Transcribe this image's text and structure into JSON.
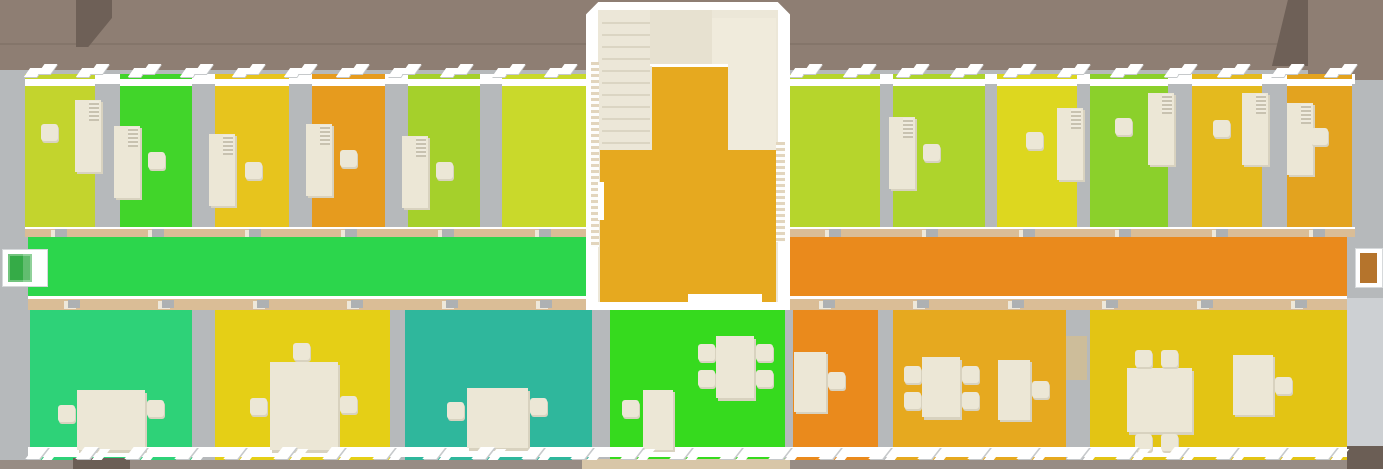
{
  "palette": {
    "roof": "#8e7e73",
    "roofDark": "#6e6057",
    "wall": "#b6b9bb",
    "wallLight": "#cdd0d3",
    "cream": "#ece7d6",
    "creamShadow": "#d8d2bf",
    "stairInterior": "#ece7d8",
    "stairStep": "#dbd5c3",
    "stairLanding": "#f0ebdc",
    "stairUpper": "#e7e1d0",
    "doorStrip": "#dabd96",
    "doorPanel": "#aeb1b3",
    "ground": "#978c84",
    "groundDark": "#6b5e55",
    "groundTan": "#d8c6a8"
  },
  "building": {
    "north_offices": [
      {
        "name": "north-office-1",
        "floor_color": "#c3d42d",
        "furniture": [
          "desk",
          "office-chair"
        ]
      },
      {
        "name": "north-office-2",
        "floor_color": "#41d52a",
        "furniture": [
          "desk",
          "office-chair"
        ]
      },
      {
        "name": "north-office-3",
        "floor_color": "#e7c41d",
        "furniture": [
          "desk",
          "office-chair"
        ]
      },
      {
        "name": "north-office-4",
        "floor_color": "#e69b1e",
        "furniture": [
          "desk",
          "office-chair"
        ]
      },
      {
        "name": "north-office-5",
        "floor_color": "#a5d02b",
        "furniture": [
          "desk",
          "office-chair"
        ]
      },
      {
        "name": "north-office-6",
        "floor_color": "#c9d92b",
        "furniture": []
      },
      {
        "name": "north-office-7",
        "floor_color": "#b6d52c",
        "furniture": []
      },
      {
        "name": "north-office-8",
        "floor_color": "#aed42c",
        "furniture": [
          "desk",
          "office-chair"
        ]
      },
      {
        "name": "north-office-9",
        "floor_color": "#ddd71f",
        "furniture": [
          "desk",
          "office-chair"
        ]
      },
      {
        "name": "north-office-10",
        "floor_color": "#8bd02b",
        "furniture": [
          "desk",
          "office-chair"
        ]
      },
      {
        "name": "north-office-11",
        "floor_color": "#e4ba1e",
        "furniture": [
          "desk",
          "office-chair"
        ]
      },
      {
        "name": "north-office-12",
        "floor_color": "#e3a31f",
        "furniture": [
          "desk",
          "office-chair"
        ]
      }
    ],
    "corridor": {
      "west_floor_color": "#2cd64c",
      "east_floor_color": "#ea8a1c",
      "west_door_color": "#35ab47",
      "east_door_color": "#b5742c"
    },
    "stairwell": {
      "floor_color": "#e6a91f",
      "stair_color": "#ece7d8"
    },
    "south_rooms": [
      {
        "name": "south-room-1",
        "floor_color": "#2ed278",
        "furniture": [
          "table",
          "chair",
          "chair"
        ]
      },
      {
        "name": "south-room-2",
        "floor_color": "#e5cf16",
        "furniture": [
          "table",
          "chair",
          "chair",
          "chair"
        ]
      },
      {
        "name": "south-room-3",
        "floor_color": "#2fb79c",
        "furniture": [
          "table",
          "chair",
          "chair"
        ]
      },
      {
        "name": "south-room-4",
        "floor_color": "#36da1e",
        "furniture": [
          "desk",
          "chair",
          "meeting-table",
          "chair",
          "chair",
          "chair",
          "chair"
        ]
      },
      {
        "name": "south-room-5",
        "floor_color": "#ea8a1c",
        "furniture": [
          "desk",
          "chair"
        ]
      },
      {
        "name": "south-room-6",
        "floor_color": "#e6a91f",
        "furniture": [
          "table",
          "chair",
          "chair",
          "chair",
          "chair",
          "desk",
          "chair"
        ]
      },
      {
        "name": "south-room-7",
        "floor_color": "#e3c414",
        "furniture": [
          "meeting-table",
          "chair",
          "chair",
          "chair",
          "chair",
          "desk",
          "chair"
        ]
      }
    ]
  }
}
